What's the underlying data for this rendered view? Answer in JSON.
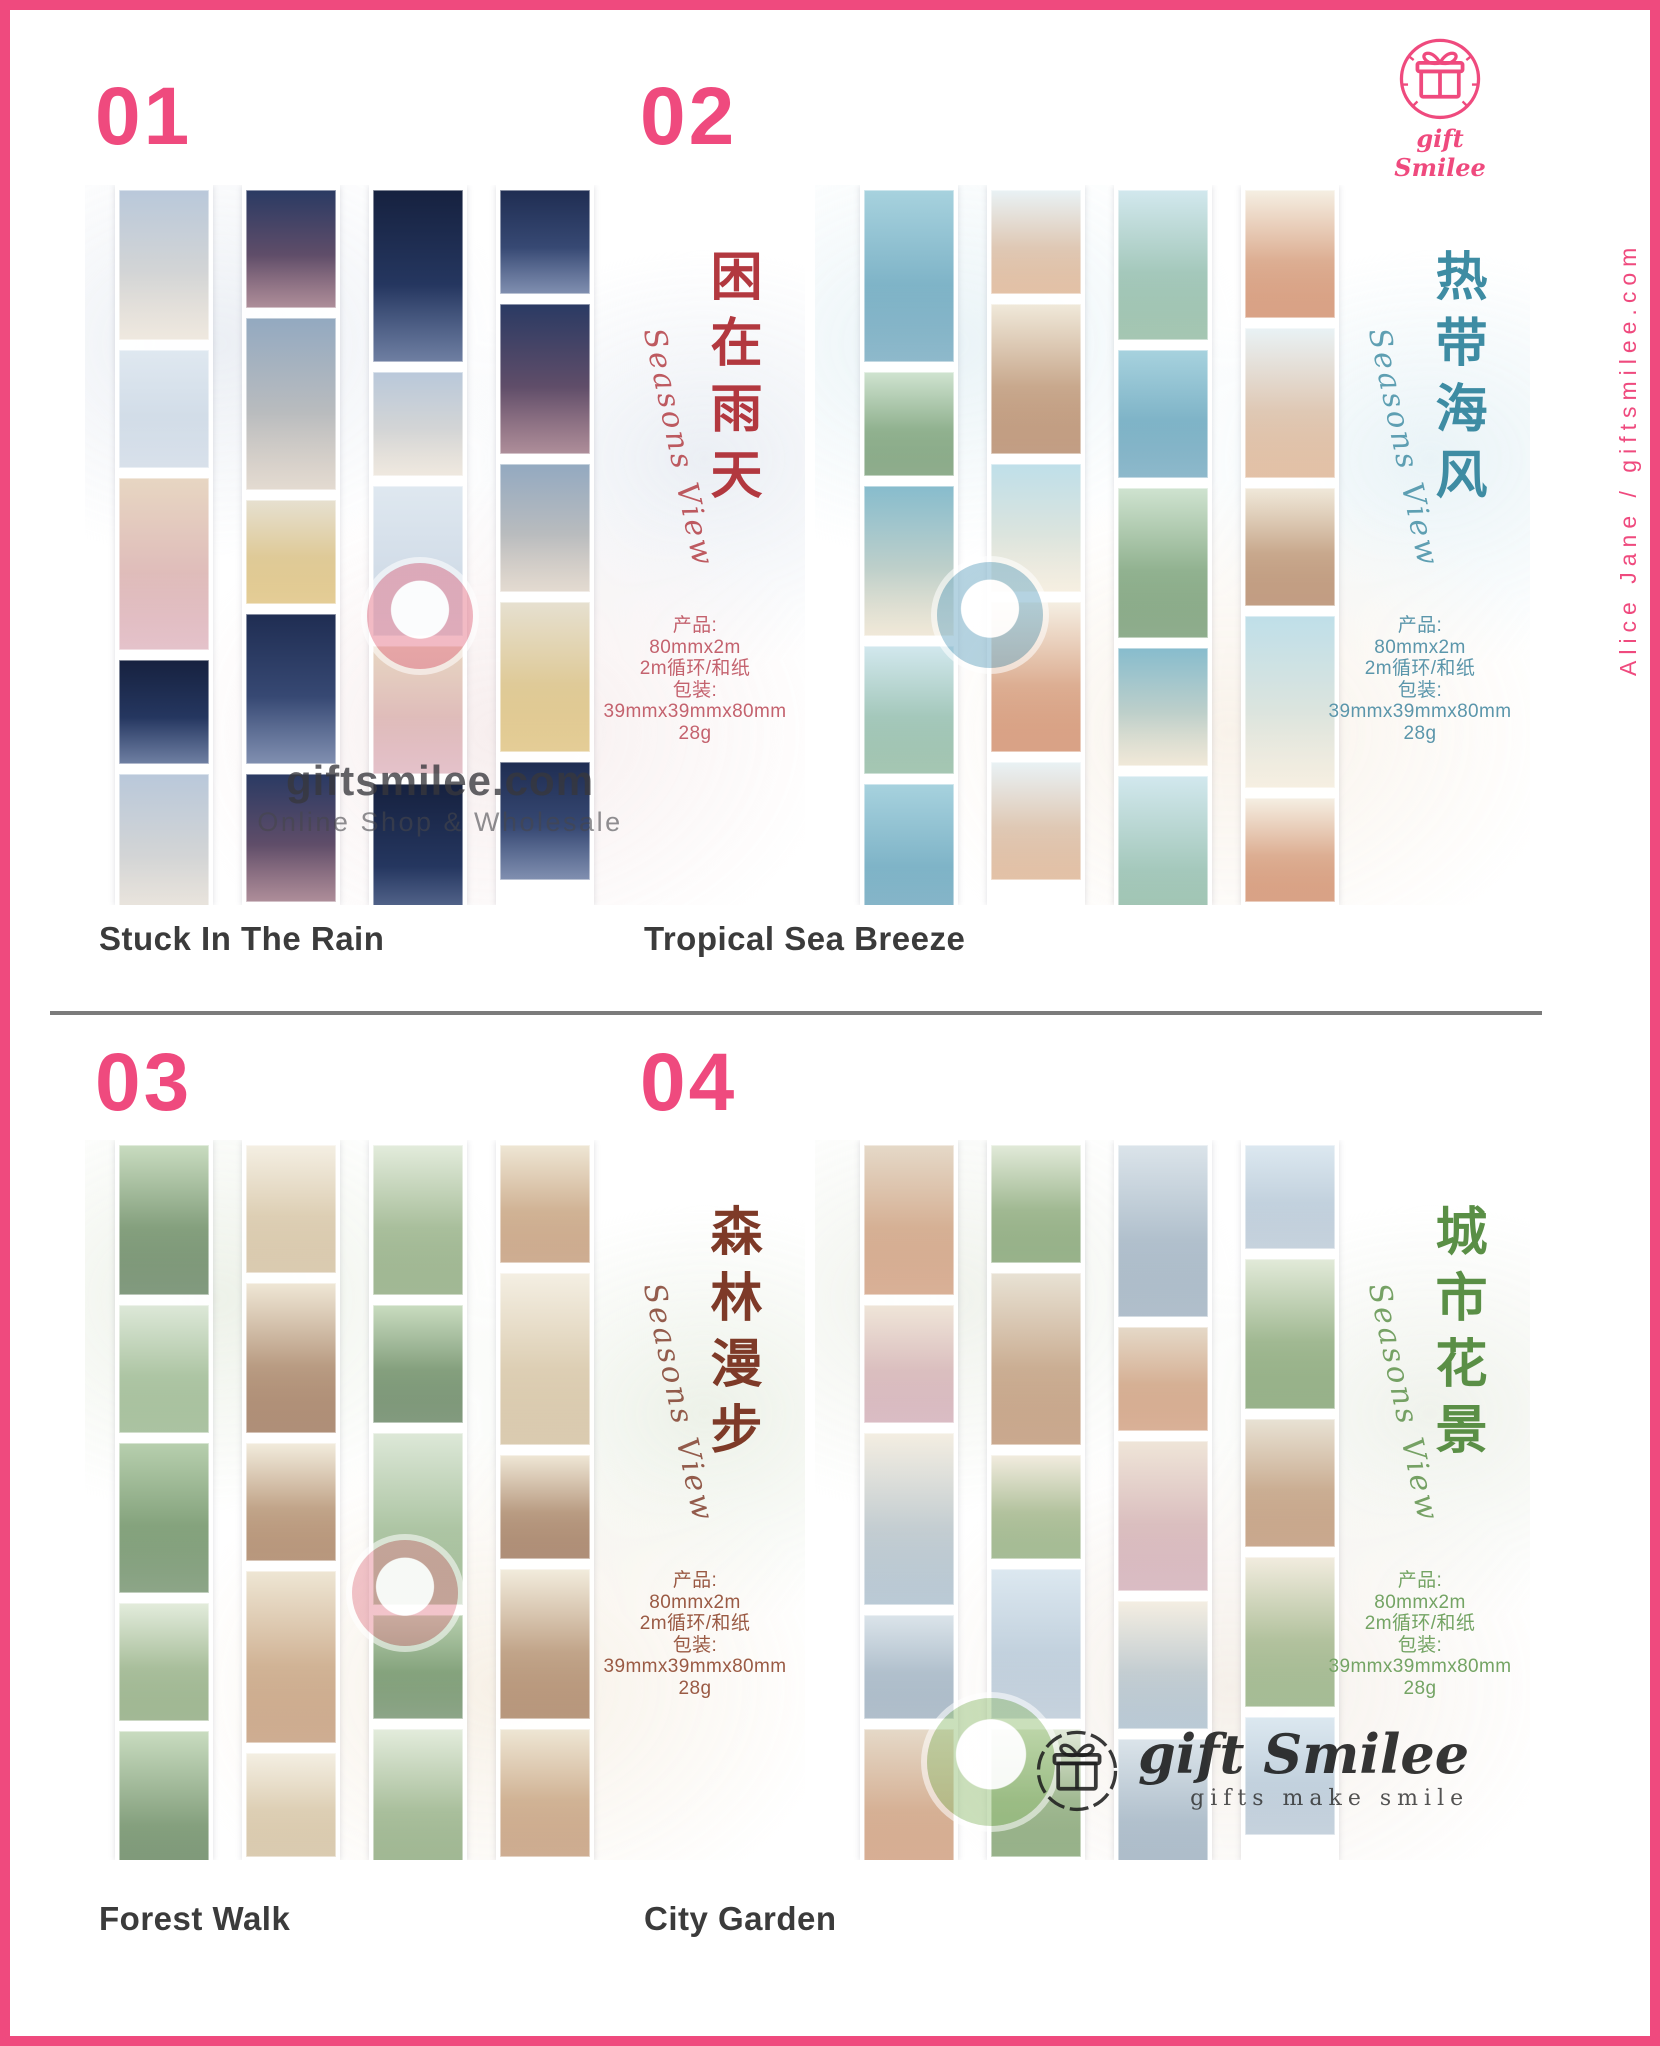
{
  "brand": {
    "logo_text": "gift Smilee",
    "side_text": "Alice Jane / giftsmilee.com",
    "pink": "#ef4a7e"
  },
  "divider_color": "#7b7b7b",
  "watermark_top": {
    "line1": "giftsmilee.com",
    "line2": "Online Shop & Wholesale"
  },
  "watermark_bottom": {
    "script": "gift Smilee",
    "tagline": "gifts make smile"
  },
  "products": [
    {
      "number": "01",
      "name": "Stuck In The Rain",
      "calligraphy": "困在雨天",
      "script": "Seasons View",
      "accent": "#b2383f",
      "spec_color": "#c4626e",
      "wash": [
        "#e9edf3",
        "#f6ecec"
      ],
      "sticker": "rgba(228,118,138,0.50)",
      "specs": [
        "产品:",
        "80mmx2m",
        "2m循环/和纸",
        "包装:",
        "39mmx39mmx80mm",
        "28g"
      ],
      "palette": [
        [
          "#b9c8da",
          "#e8dfd2"
        ],
        [
          "#1f2d52",
          "#4a5f8e"
        ],
        [
          "#dfe8f0",
          "#c8d4e2"
        ],
        [
          "#2a3a63",
          "#8b5d6e"
        ],
        [
          "#e7d6c2",
          "#d9a8b4"
        ],
        [
          "#93a9c0",
          "#d8cbbd"
        ],
        [
          "#16213f",
          "#31487a"
        ],
        [
          "#e6e0d0",
          "#d9b86a"
        ]
      ]
    },
    {
      "number": "02",
      "name": "Tropical Sea Breeze",
      "calligraphy": "热带海风",
      "script": "Seasons View",
      "accent": "#3e8ca3",
      "spec_color": "#5b96ab",
      "wash": [
        "#e7f2f6",
        "#f8f1e8"
      ],
      "sticker": "rgba(120,175,200,0.55)",
      "specs": [
        "产品:",
        "80mmx2m",
        "2m循环/和纸",
        "包装:",
        "39mmx39mmx80mm",
        "28g"
      ],
      "palette": [
        [
          "#bfdfe9",
          "#f2e8d5"
        ],
        [
          "#a7d2de",
          "#5e9bb5"
        ],
        [
          "#f5efe3",
          "#c97a52"
        ],
        [
          "#cfe3d0",
          "#5f8a5c"
        ],
        [
          "#e9f2f5",
          "#d7a781"
        ],
        [
          "#87bccd",
          "#eadfc8"
        ],
        [
          "#f0e9da",
          "#a8744f"
        ],
        [
          "#d2e8ee",
          "#7fae92"
        ]
      ]
    },
    {
      "number": "03",
      "name": "Forest Walk",
      "calligraphy": "森林漫步",
      "script": "Seasons View",
      "accent": "#7e3a28",
      "spec_color": "#9a5a44",
      "wash": [
        "#ebf0e6",
        "#f6efe4"
      ],
      "sticker": "rgba(225,125,140,0.45)",
      "specs": [
        "产品:",
        "80mmx2m",
        "2m循环/和纸",
        "包装:",
        "39mmx39mmx80mm",
        "28g"
      ],
      "palette": [
        [
          "#e3ecdc",
          "#7a9a68"
        ],
        [
          "#f2ecdd",
          "#9a6b46"
        ],
        [
          "#c9dcc0",
          "#4d6f48"
        ],
        [
          "#eee6d4",
          "#b98a63"
        ],
        [
          "#dde8d8",
          "#87a97a"
        ],
        [
          "#f4efe3",
          "#cbb58f"
        ],
        [
          "#b7cfae",
          "#5c7f55"
        ],
        [
          "#efe7d6",
          "#8d5f3f"
        ]
      ]
    },
    {
      "number": "04",
      "name": "City Garden",
      "calligraphy": "城市花景",
      "script": "Seasons View",
      "accent": "#5a8f46",
      "spec_color": "#74a464",
      "wash": [
        "#eef1ea",
        "#f4eee7"
      ],
      "sticker": "rgba(150,192,120,0.50)",
      "specs": [
        "产品:",
        "80mmx2m",
        "2m循环/和纸",
        "包装:",
        "39mmx39mmx80mm",
        "28g"
      ],
      "palette": [
        [
          "#e8e2d4",
          "#b3845f"
        ],
        [
          "#dbe4ea",
          "#8fa3b5"
        ],
        [
          "#f2ecdf",
          "#7fa069"
        ],
        [
          "#e5d9c8",
          "#c98f6b"
        ],
        [
          "#dce8f0",
          "#aebfcf"
        ],
        [
          "#efe5d8",
          "#caa0ab"
        ],
        [
          "#e2ead9",
          "#6c9159"
        ],
        [
          "#f4eee2",
          "#9db3c4"
        ]
      ]
    }
  ]
}
